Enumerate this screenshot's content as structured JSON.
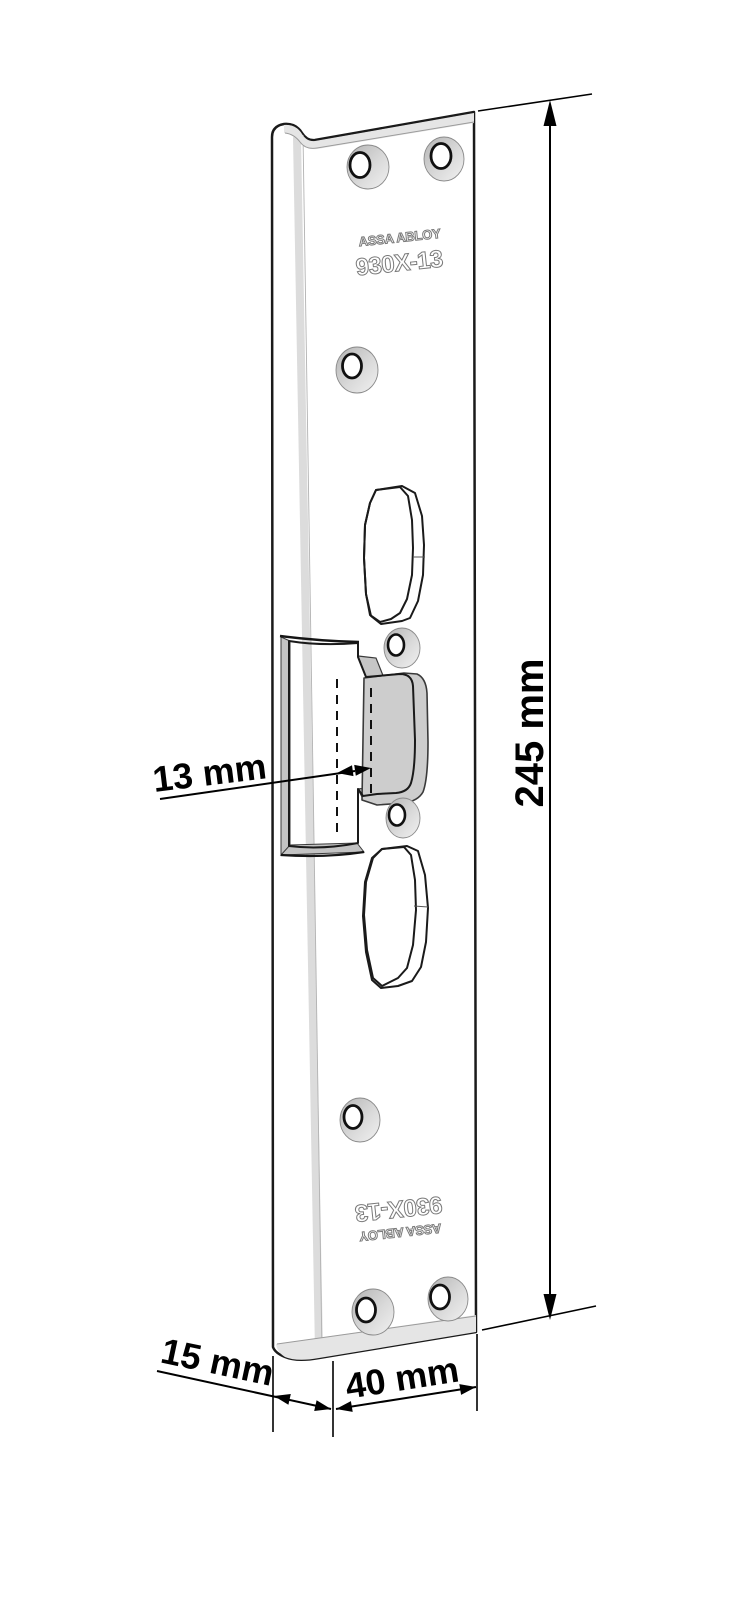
{
  "diagram": {
    "title": "ASSA ABLOY 930X-13 angled strike plate - dimensioned technical drawing",
    "engravings": {
      "top_brand": "ASSA ABLOY",
      "top_model": "930X-13",
      "bottom_model": "930X-13",
      "bottom_brand": "ASSA ABLOY"
    },
    "dimensions": {
      "overall_height": "245 mm",
      "latch_inset": "13 mm",
      "flange_depth": "15 mm",
      "face_width": "40 mm"
    },
    "colors": {
      "background": "#ffffff",
      "plate_face": "#cbcbcb",
      "plate_highlight": "#e5e5e5",
      "cut_wall": "#c9c9c9",
      "outline": "#1a1a1a",
      "engraving": "#7a7a7a",
      "dimension": "#000000"
    }
  }
}
